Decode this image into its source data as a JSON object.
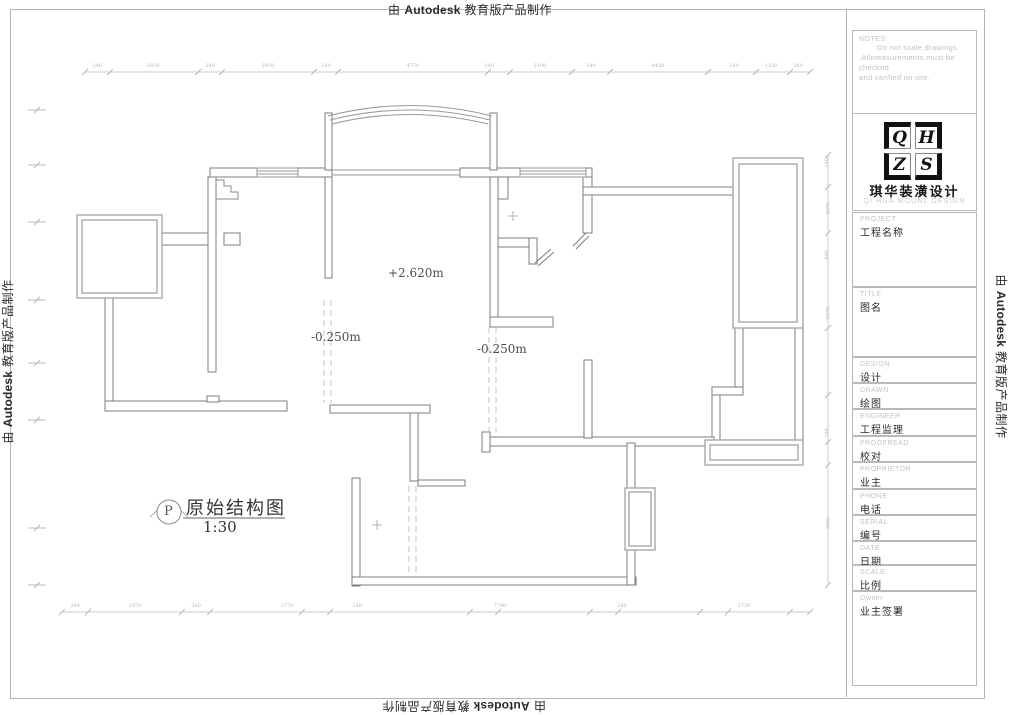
{
  "watermark": {
    "prefix": "由",
    "brand": "Autodesk",
    "suffix": "教育版产品制作"
  },
  "title_block": {
    "notes": {
      "label": "NOTES:",
      "lines": [
        "Do not scale drawings",
        ",Allmeasurements must be checked",
        "and varified on site."
      ]
    },
    "logo": {
      "letters": {
        "tl": "Q",
        "tr": "H",
        "bl": "Z",
        "br": "S"
      },
      "name_cn": "琪华装潢设计",
      "name_en": "QI HUA MOUNL DESIGN"
    },
    "fields": [
      {
        "en": "PROJECT",
        "zh": "工程名称"
      },
      {
        "en": "TITLE",
        "zh": "图名"
      },
      {
        "en": "DESIGN",
        "zh": "设计"
      },
      {
        "en": "DRAWN",
        "zh": "绘图"
      },
      {
        "en": "ENGINEER",
        "zh": "工程监理"
      },
      {
        "en": "PROOFREAD",
        "zh": "校对"
      },
      {
        "en": "PROPRIETOR",
        "zh": "业主"
      },
      {
        "en": "PHONE",
        "zh": "电话"
      },
      {
        "en": "SERIAL",
        "zh": "编号"
      },
      {
        "en": "DATE",
        "zh": "日期"
      },
      {
        "en": "SCALE",
        "zh": "比例"
      },
      {
        "en": "Owner",
        "zh": "业主签署"
      }
    ]
  },
  "plan": {
    "level_center": "+2.620m",
    "level_left": "-0.250m",
    "level_right": "-0.250m",
    "title": "原始结构图",
    "scale": "1:30",
    "symbol": "P"
  },
  "dimensions": {
    "top": [
      "240",
      "2970",
      "240",
      "2970",
      "240",
      "4770",
      "240",
      "2190",
      "240",
      "4450",
      "240",
      "1330",
      "240"
    ],
    "bottom": [
      "240",
      "2970",
      "240",
      "3770",
      "240",
      "7790",
      "240",
      "1730"
    ],
    "right": [
      "240",
      "3075",
      "840",
      "3370",
      "240",
      "3045"
    ]
  }
}
